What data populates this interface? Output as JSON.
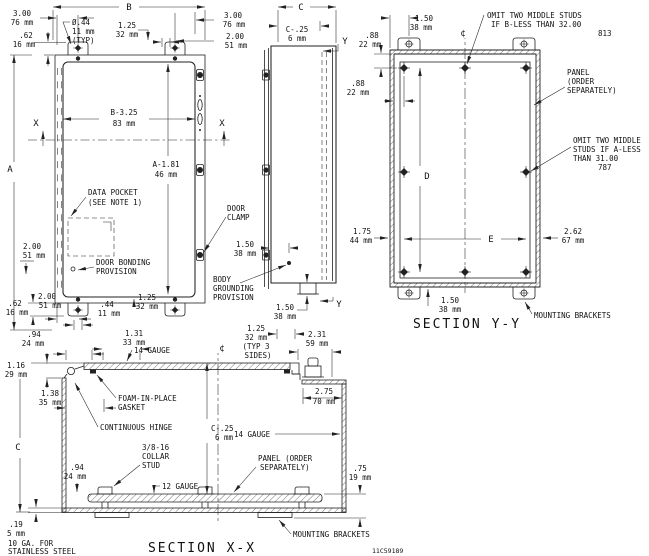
{
  "fv": {
    "b": "B",
    "a": "A",
    "x": "X",
    "d1_in": "3.00",
    "d1_mm": "76 mm",
    "d2_in": ".62",
    "d2_mm": "16 mm",
    "hole_dia": "Ø.44",
    "hole_mm": "11 mm",
    "hole_typ": "(TYP)",
    "d3_in": "1.25",
    "d3_mm": "32 mm",
    "d4_in": "3.00",
    "d4_mm": "76 mm",
    "d5_in": "2.00",
    "d5_mm": "51 mm",
    "dw_in": "B-3.25",
    "dw_mm": "83 mm",
    "dh_in": "A-1.81",
    "dh_mm": "46 mm",
    "pocket1": "DATA POCKET",
    "pocket2": "(SEE NOTE 1)",
    "clamp1": "DOOR",
    "clamp2": "CLAMP",
    "d6_in": "2.00",
    "d6_mm": "51 mm",
    "bond1": "DOOR BONDING",
    "bond2": "PROVISION",
    "d7_in": ".62",
    "d7_mm": "16 mm",
    "d8_in": "2.00",
    "d8_mm": "51 mm",
    "d9_in": ".44",
    "d9_mm": "11 mm",
    "d10_in": "1.25",
    "d10_mm": "32 mm"
  },
  "sv": {
    "c": "C",
    "y": "Y",
    "d1_in": "C-.25",
    "d1_mm": "6 mm",
    "d2_in": "1.50",
    "d2_mm": "38 mm",
    "gnd1": "BODY",
    "gnd2": "GROUNDING",
    "gnd3": "PROVISION",
    "d3_in": "1.50",
    "d3_mm": "38 mm"
  },
  "yy": {
    "caption": "SECTION Y-Y",
    "cl": "¢",
    "d": "D",
    "e": "E",
    "d1_in": ".88",
    "d1_mm": "22 mm",
    "d2_in": "1.50",
    "d2_mm": "38 mm",
    "d3_in": ".88",
    "d3_mm": "22 mm",
    "noteb1": "OMIT TWO MIDDLE STUDS",
    "noteb2": "IF B-LESS THAN 32.00",
    "noteb3": "813",
    "panel1": "PANEL",
    "panel2": "(ORDER",
    "panel3": "SEPARATELY)",
    "notea1": "OMIT TWO MIDDLE",
    "notea2": "STUDS IF A-LESS",
    "notea3": "THAN 31.00",
    "notea4": "787",
    "d4_in": "1.75",
    "d4_mm": "44 mm",
    "d5_in": "2.62",
    "d5_mm": "67 mm",
    "d6_in": "1.50",
    "d6_mm": "38 mm",
    "mb": "MOUNTING BRACKETS"
  },
  "xx": {
    "caption": "SECTION X-X",
    "cl": "¢",
    "c": "C",
    "dwg": "11C59189",
    "d1_in": ".94",
    "d1_mm": "24 mm",
    "d2_in": "1.31",
    "d2_mm": "33 mm",
    "g14a": "14 GAUGE",
    "d3_in": "1.25",
    "d3_mm": "32 mm",
    "d3_t1": "(TYP 3",
    "d3_t2": "SIDES)",
    "d4_in": "2.31",
    "d4_mm": "59 mm",
    "d5_in": "1.16",
    "d5_mm": "29 mm",
    "d6_in": "1.38",
    "d6_mm": "35 mm",
    "foam1": "FOAM-IN-PLACE",
    "foam2": "GASKET",
    "hinge": "CONTINUOUS HINGE",
    "d7_in": "2.75",
    "d7_mm": "70 mm",
    "d8_in": "C-.25",
    "d8_mm": "6 mm",
    "g14b": "14 GAUGE",
    "stud1": "3/8-16",
    "stud2": "COLLAR",
    "stud3": "STUD",
    "d9_in": ".94",
    "d9_mm": "24 mm",
    "g12": "12 GAUGE",
    "panel1": "PANEL (ORDER",
    "panel2": "SEPARATELY)",
    "d10_in": ".75",
    "d10_mm": "19 mm",
    "d11_in": ".19",
    "d11_mm": "5 mm",
    "mat1": "10 GA. FOR",
    "mat2": "STAINLESS STEEL",
    "mb": "MOUNTING BRACKETS"
  }
}
